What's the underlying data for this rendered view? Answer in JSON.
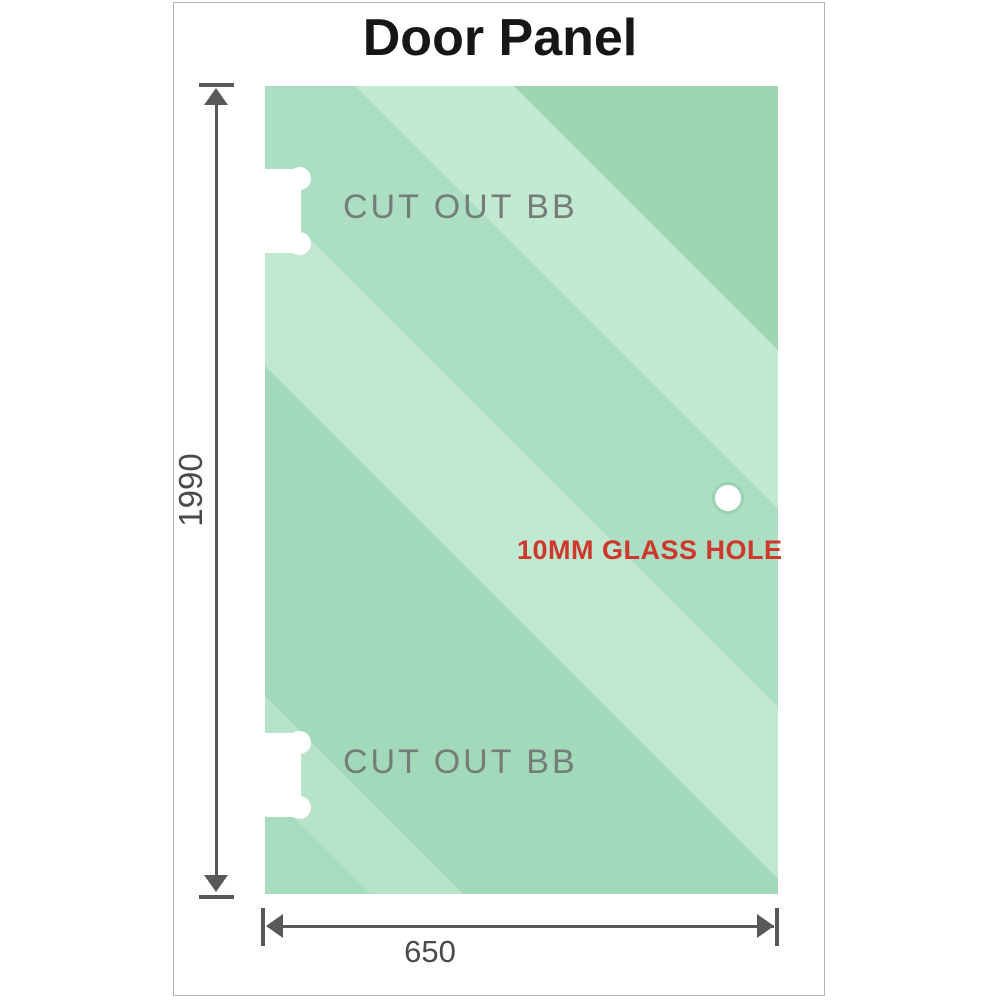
{
  "title": "Door Panel",
  "glass": {
    "cutout_top_label": "CUT OUT BB",
    "cutout_bottom_label": "CUT OUT BB",
    "hole_label": "10MM GLASS HOLE"
  },
  "dimensions": {
    "height_value": "1990",
    "width_value": "650"
  },
  "colors": {
    "glass_green_base": "#a2d9ba",
    "glass_green_light": "#c2e9d2",
    "hole_label_red": "#ce372b",
    "cutout_label_gray": "#767d78",
    "dimension_gray": "#58595b",
    "frame_border": "#b3b3b3",
    "title_black": "#161616"
  }
}
